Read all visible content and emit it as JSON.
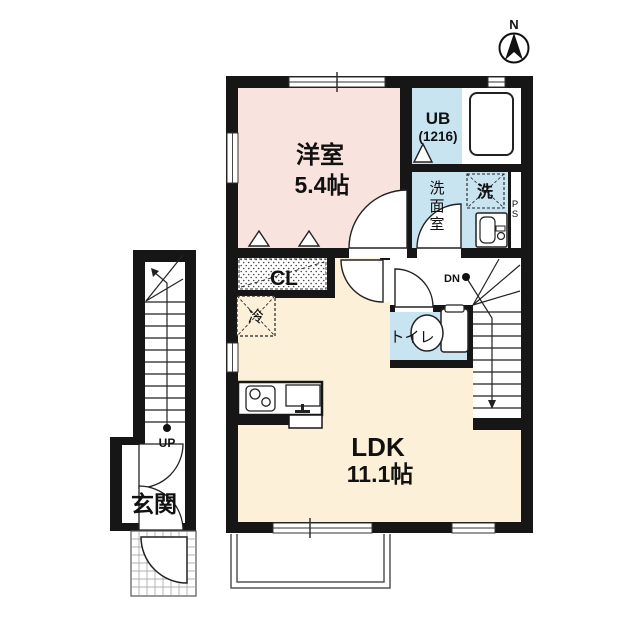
{
  "compass": {
    "north": "N"
  },
  "labels": {
    "western_room_name": "洋室",
    "western_room_size": "5.4帖",
    "ldk_name": "LDK",
    "ldk_size": "11.1帖",
    "unit_bath_name": "UB",
    "unit_bath_size": "(1216)",
    "washroom_char_0": "洗",
    "washroom_char_1": "面",
    "washroom_char_2": "室",
    "washer": "洗",
    "fridge": "冷",
    "closet": "CL",
    "toilet": "トイレ",
    "entrance": "玄関",
    "pipe_space_char_0": "P",
    "pipe_space_char_1": "S",
    "stairs_down": "DN",
    "stairs_up": "UP"
  },
  "colors": {
    "wall": "#161616",
    "western_room": "#f9e3de",
    "ldk": "#fcf1d8",
    "wet_area": "#c9e4f1",
    "paper": "#ffffff"
  }
}
